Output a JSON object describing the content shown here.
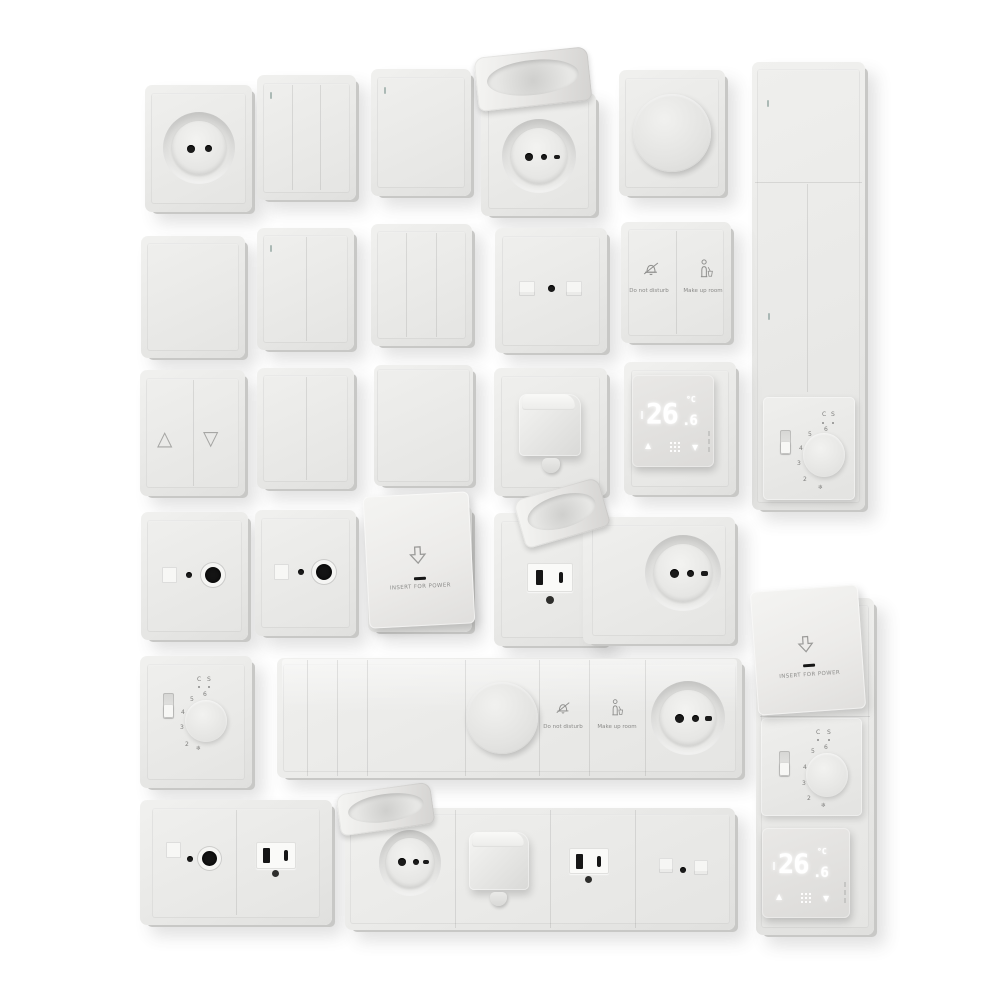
{
  "scene": {
    "description": "3D render catalog of white electrical wall plates: switches, schuko sockets, lidded sockets, dimmers, data and TV sockets, US outlets, hooded outlets, key-card switches, hotel service buttons, analog and digital thermostats, on a white background"
  },
  "colors": {
    "background": "#ffffff",
    "plate": "#e8e8e6",
    "plate_side": "#c8c8c6",
    "detail_dark": "#1a1a1a",
    "icon_gray": "#8f8f8d",
    "display_glow": "#ffffff",
    "led_indicator": "#9fafab"
  },
  "labels": {
    "insert_for_power": "INSERT FOR POWER",
    "do_not_disturb": "Do not disturb",
    "make_up_room": "Make up room"
  },
  "digital_thermostat": {
    "temperature_integer": "26",
    "temperature_decimal": ".6",
    "unit": "°C"
  },
  "analog_thermostat": {
    "scale": [
      "2",
      "3",
      "4",
      "5",
      "6"
    ],
    "mode_labels": [
      "C",
      "S"
    ],
    "frost_symbol": "❄"
  },
  "glyphs": {
    "shutter_up": "△",
    "shutter_down": "▽",
    "temp_up": "▲",
    "temp_down": "▼"
  },
  "icons": {
    "do-not-disturb-icon": "bell with slash (outline svg)",
    "make-up-room-icon": "housekeeping person (outline svg)",
    "insert-card-icon": "downward outline arrow",
    "shutter-up-icon": "△",
    "shutter-down-icon": "▽",
    "temp-up-icon": "▲",
    "temp-down-icon": "▼",
    "menu-dots-icon": "3x3 white dot grid",
    "frost-icon": "❄"
  }
}
